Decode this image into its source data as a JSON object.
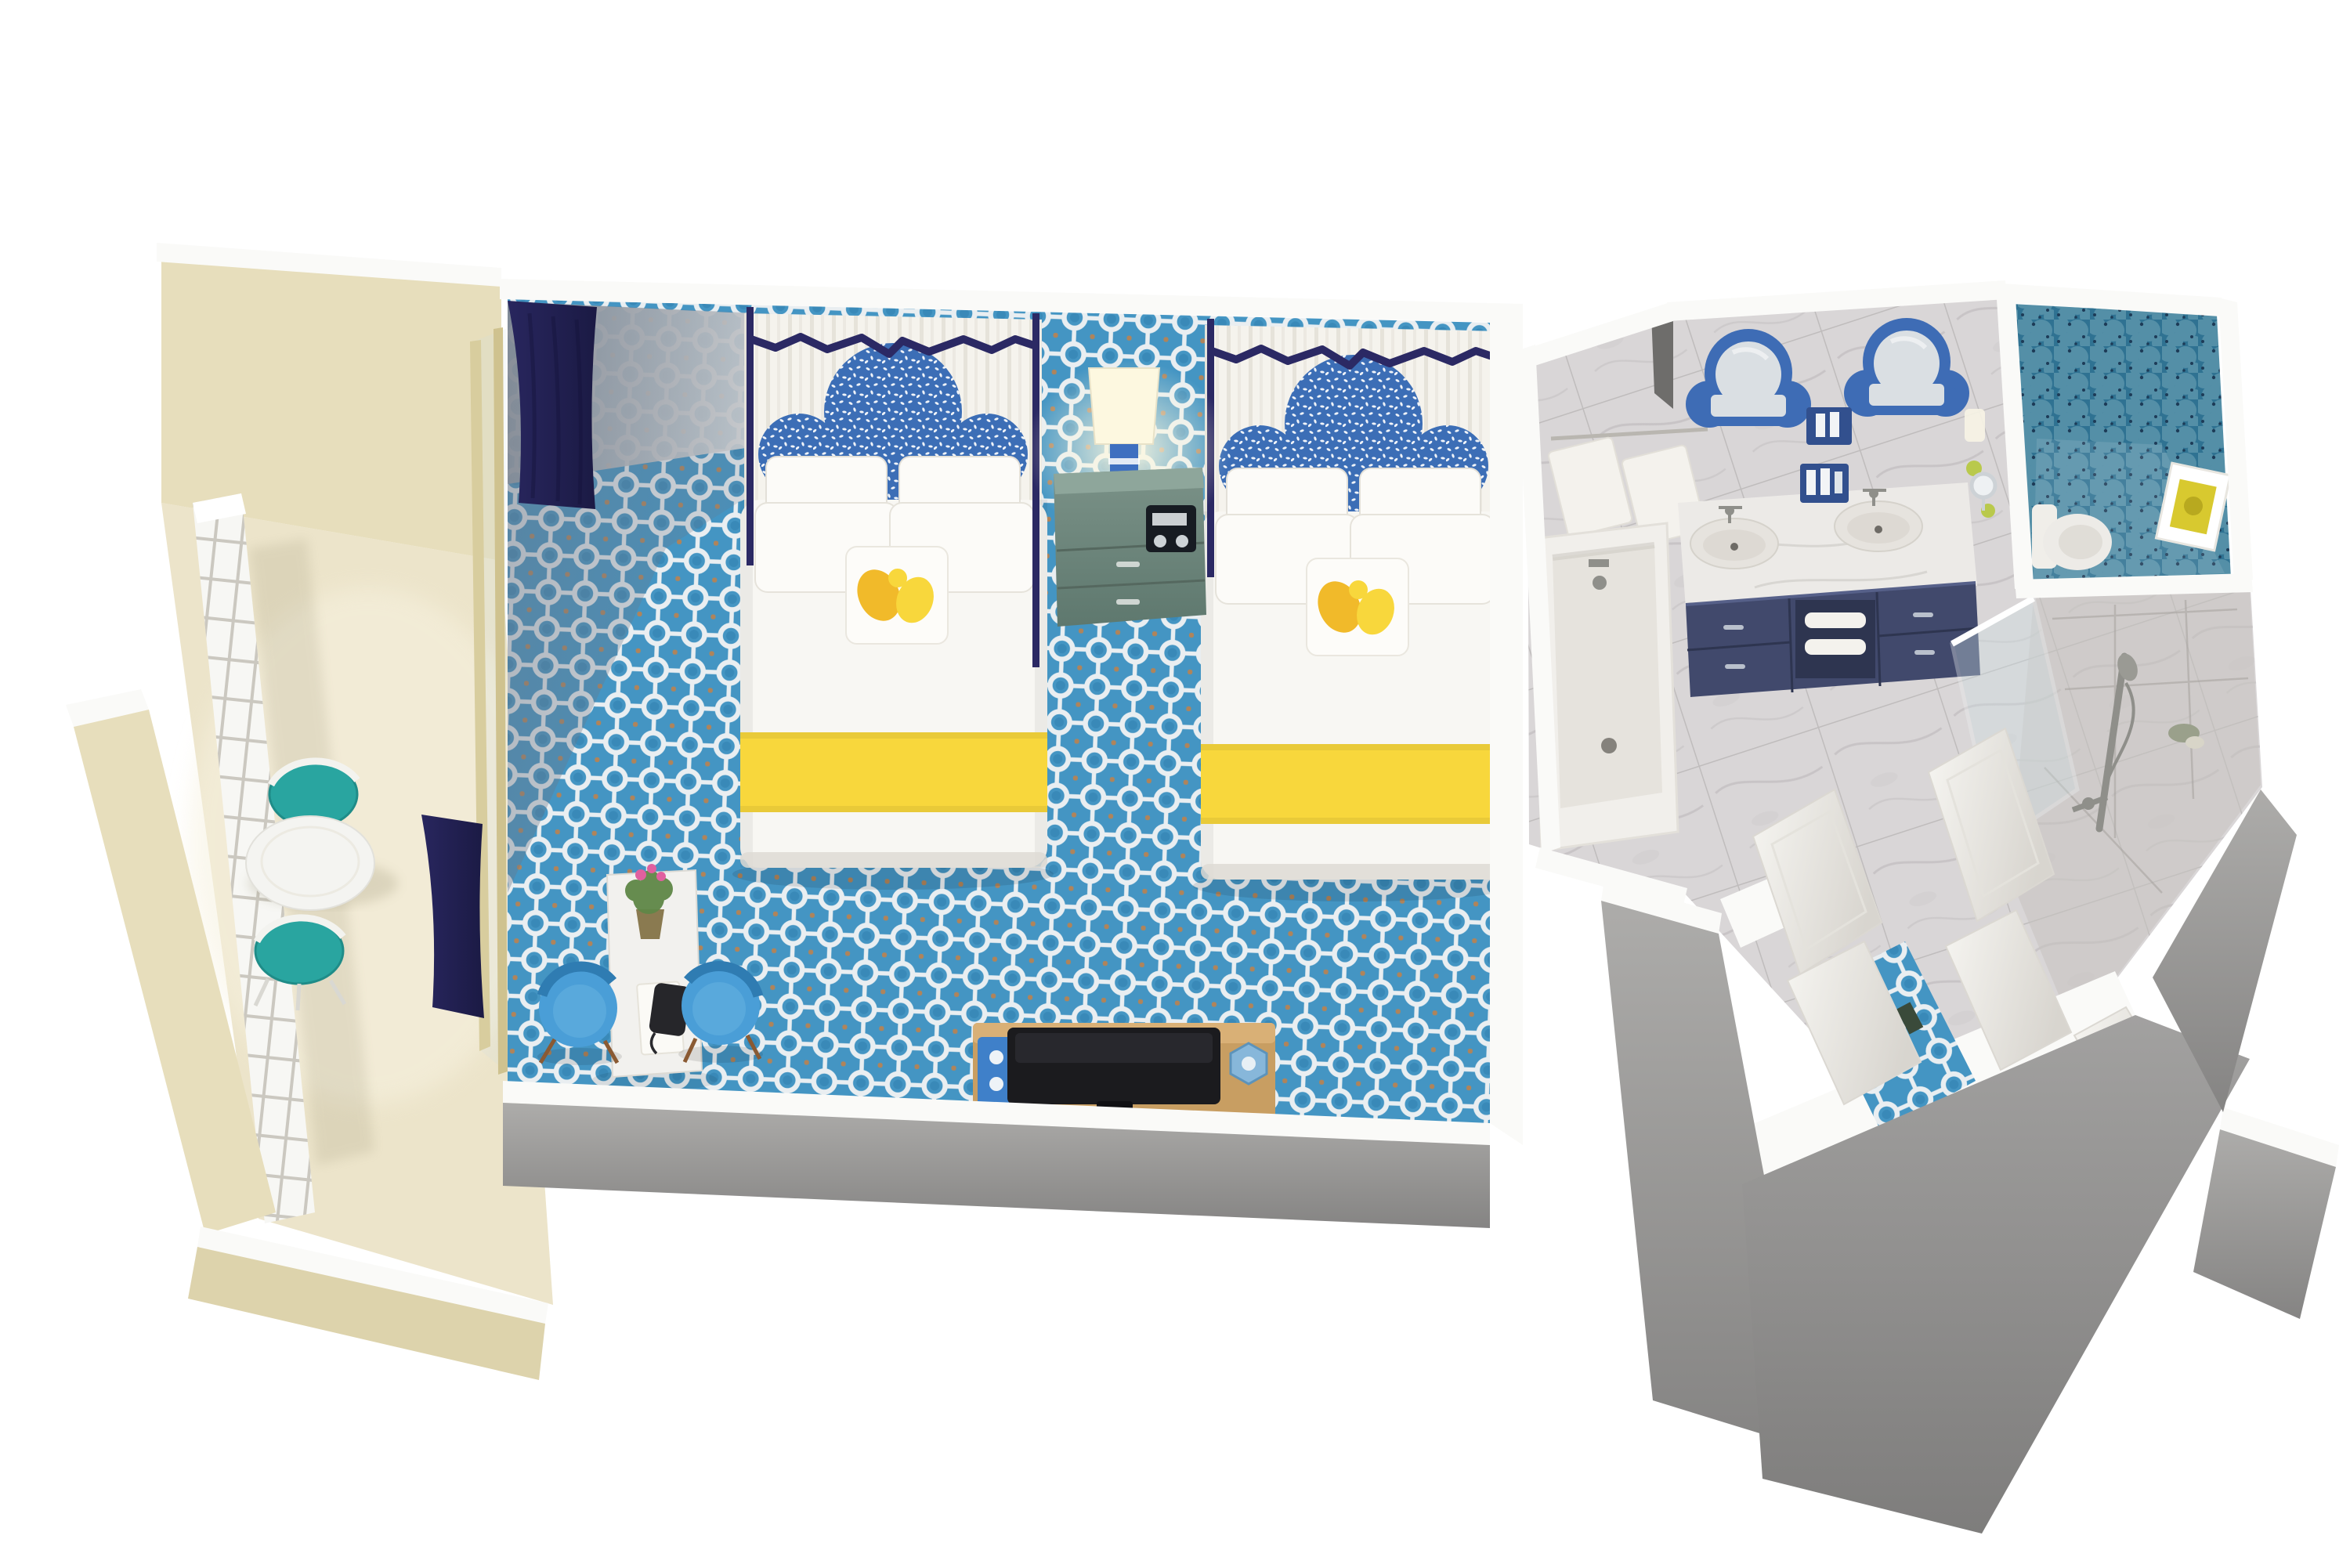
{
  "scene": {
    "kind": "isometric-floorplan-render",
    "rooms": {
      "balcony": {
        "name": "balcony",
        "furniture": [
          "round-cafe-table",
          "teal-cafe-chair",
          "teal-cafe-chair",
          "white-railing",
          "beige-parapet"
        ]
      },
      "bedroom": {
        "name": "bedroom",
        "furniture": [
          "canopy-bed-1",
          "canopy-bed-2",
          "nightstand",
          "table-lamp",
          "alarm-clock",
          "writing-desk",
          "desk-chair-left",
          "desk-chair-right",
          "tv-console",
          "television",
          "drink-tray",
          "ice-bucket",
          "flower-pot",
          "telephone",
          "navy-curtain",
          "navy-curtain",
          "ring-pattern-carpet",
          "sliding-glass-door"
        ]
      },
      "bathroom": {
        "name": "bathroom",
        "furniture": [
          "bathtub",
          "hanging-towels",
          "double-vanity",
          "sink",
          "sink",
          "ornate-mirror",
          "ornate-mirror",
          "amenity-caddy",
          "magnifying-mirror",
          "towel-shelf"
        ]
      },
      "water-closet": {
        "name": "water-closet",
        "furniture": [
          "toilet",
          "framed-art",
          "fishscale-mosaic-wallpaper"
        ]
      },
      "shower-room": {
        "name": "shower-room",
        "furniture": [
          "handheld-shower-rail",
          "glass-panel",
          "drain-amenities"
        ]
      },
      "entry": {
        "name": "entry",
        "furniture": [
          "open-door",
          "open-door",
          "open-door",
          "open-door",
          "carpet-runner",
          "sectioned-gray-walls"
        ]
      }
    }
  },
  "colors": {
    "background": "#ffffff",
    "wall_white": "#fafaf8",
    "wall_face": "#efede8",
    "wall_dark_wedge": "#6e6d6b",
    "gray_top": "#adacaa",
    "gray_bottom": "#858483",
    "gray_top2": "#a2a1a0",
    "gray_bottom2": "#7e7d7c",
    "carpet_blue": "#4495c3",
    "carpet_ring": "#e9eef1",
    "carpet_accent": "#c97f41",
    "beige_wall": "#e7debc",
    "beige_wall_dark": "#ddd3ac",
    "balcony_floor": "#ece4ca",
    "balcony_wash": "#f7f2e0",
    "railing_white": "#f7f7f4",
    "railing_grid": "#c6c3ba",
    "curtain_navy": "#28265e",
    "curtain_navy_dark": "#1b1a44",
    "canopy_navy": "#2b2964",
    "backdrop_white": "#f5f3ed",
    "backdrop_stripe": "#e6e3da",
    "headboard_blue": "#3c6eb6",
    "headboard_speck": "#ffffff",
    "bedding_white": "#f8f7f3",
    "pillow_white": "#fcfbf8",
    "bedding_shadow": "#dedbd3",
    "throw_yellow": "#f8d73c",
    "accent_yellow": "#f0b61f",
    "nightstand_teal": "#7b9288",
    "nightstand_teal_dark": "#5e786e",
    "nightstand_top": "#8ea69b",
    "clock_black": "#171b22",
    "lamp_glow": "#fdf8e0",
    "lamp_blue": "#3e6fc0",
    "desk_white": "#f2f1ee",
    "chair_blue": "#4a9ed7",
    "chair_blue_dark": "#2f7cb2",
    "plant_green": "#5f8747",
    "flower_pink": "#e0609f",
    "pot_brown": "#8a7a50",
    "phone_black": "#26262a",
    "tv_black": "#1b1b1e",
    "console_wood": "#c89e62",
    "console_wood_light": "#d9b076",
    "tray_blue": "#3f80c9",
    "bucket_blue": "#87b7da",
    "teal_chair": "#29a5a0",
    "teal_chair_dark": "#1f8c88",
    "table_white": "#f4f4f1",
    "marble_base": "#d9d6d7",
    "marble_vein": "#c1bdbf",
    "marble_grout": "#bfbcbc",
    "marble_blotch": "#cfcbcd",
    "counter_white": "#eceae7",
    "vanity_navy": "#41496c",
    "vanity_navy_dark": "#2e3550",
    "vanity_handle": "#b9c0cc",
    "mirror_frame_blue": "#3e6cb5",
    "mirror_glass": "#dadfe3",
    "sink_white": "#e6e3de",
    "sink_inner": "#ddd9d3",
    "fixture_gray": "#8f8f8a",
    "towel_white": "#f4f2ed",
    "tub_white": "#f1efeb",
    "tub_inner": "#e6e3dd",
    "mosaic_teal": "#2f7292",
    "mosaic_light": "#7fb0c0",
    "mosaic_dark": "#1d3b57",
    "art_yellow": "#d8c92f",
    "door_white": "#f6f5f1",
    "door_edge": "#d8d5cf",
    "glass_blue": "#cfe0e4",
    "shower_tile": "#c6c2bf",
    "caddy_blue": "#32508e",
    "lime_green": "#b9c94c",
    "frame_tan": "#d8cd9e",
    "frame_tan2": "#cfc28f",
    "shadow_gray": "#6c7685",
    "wallshade_gray": "#a3a5aa"
  }
}
